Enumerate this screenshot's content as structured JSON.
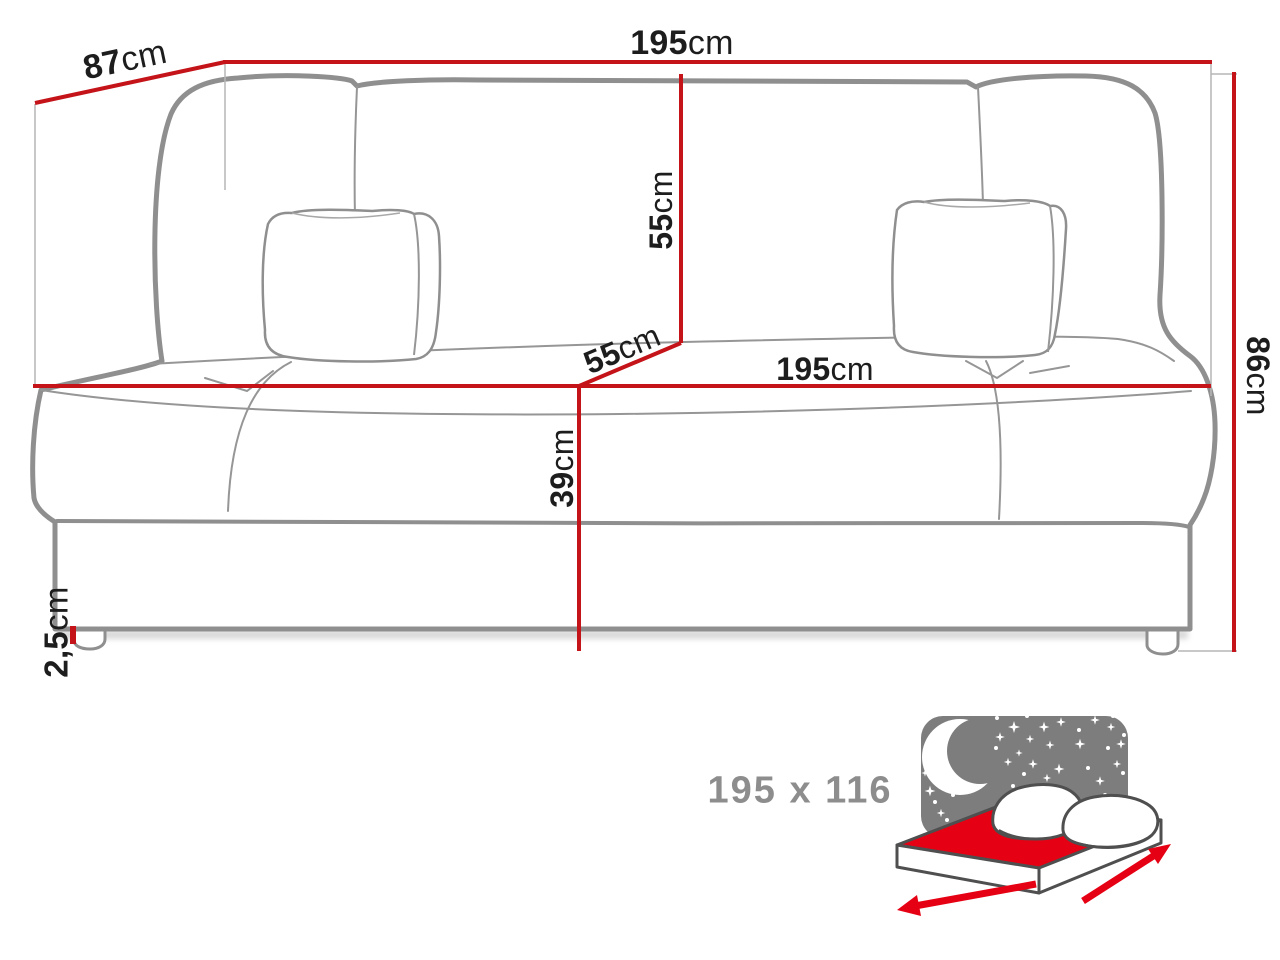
{
  "diagram_type": "sofa-bed dimension diagram",
  "dimensions": {
    "depth": {
      "value": "87",
      "unit": "cm"
    },
    "width_top": {
      "value": "195",
      "unit": "cm"
    },
    "backrest_height": {
      "value": "55",
      "unit": "cm"
    },
    "seat_depth": {
      "value": "55",
      "unit": "cm"
    },
    "seat_width": {
      "value": "195",
      "unit": "cm"
    },
    "total_height": {
      "value": "86",
      "unit": "cm"
    },
    "seat_height": {
      "value": "39",
      "unit": "cm"
    },
    "leg_height": {
      "value": "2,5",
      "unit": "cm"
    }
  },
  "bed_icon": {
    "sleeping_area": "195 x 116"
  },
  "colors": {
    "dimension_line_red": "#c41419",
    "bed_red": "#e60013",
    "night_sky_gray": "#7d7d7d",
    "sofa_outline_gray": "#8f8f8f",
    "label_text": "#1d1d1d",
    "muted_gray_text": "#8d8d8d"
  }
}
